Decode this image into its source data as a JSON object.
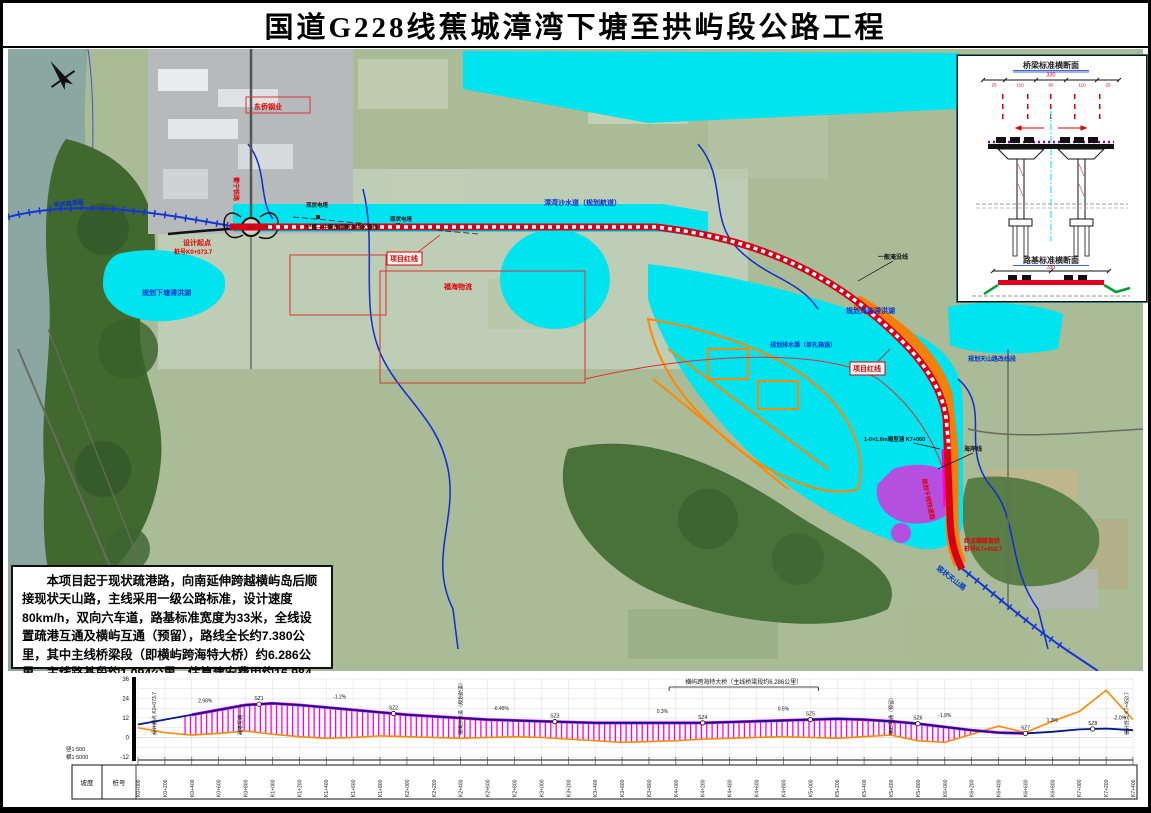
{
  "title": "国道G228线蕉城漳湾下塘至拱屿段公路工程",
  "description": "本项目起于现状疏港路，向南延伸跨越横屿岛后顺接现状天山路，主线采用一级公路标准，设计速度80km/h，双向六车道，路基标准宽度为33米，全线设置疏港互通及横屿互通（预留），路线全长约7.380公里，其中主线桥梁段（即横屿跨海特大桥）约6.286公里，主线路基段约1.094公里。估算建安费用约16.984亿元，总投资约20.931亿元。",
  "colors": {
    "route_red": "#d40018",
    "water_cyan": "#00e4f0",
    "boundary_blue": "#0b2fd0",
    "ground_orange": "#ff8800",
    "design_blue": "#001a8c",
    "bridge_hatch": "#ff00dd",
    "accent_purple": "#b44fe0",
    "label_red": "#e00000",
    "label_blue": "#0033cc"
  },
  "inset": {
    "section1_title": "桥梁标准横断面",
    "section2_title": "路基标准横断面",
    "total_width": "330",
    "dims": [
      "25",
      "110",
      "60",
      "110",
      "25"
    ]
  },
  "map_labels": [
    {
      "text": "项目红线",
      "x": 382,
      "y": 212,
      "color": "#e00000",
      "boxed": true,
      "leader": [
        432,
        186
      ]
    },
    {
      "text": "项目红线",
      "x": 845,
      "y": 322,
      "color": "#e00000",
      "boxed": true,
      "leader": [
        882,
        300
      ]
    },
    {
      "text": "设计起点",
      "x": 175,
      "y": 196,
      "color": "#e00000",
      "fs": 7
    },
    {
      "text": "桩号K0+073.7",
      "x": 166,
      "y": 205,
      "color": "#e00000",
      "fs": 6
    },
    {
      "text": "规划下塘滞洪湖",
      "x": 134,
      "y": 246,
      "color": "#0033cc",
      "fs": 7
    },
    {
      "text": "漳湾沙水道（规划航道）",
      "x": 536,
      "y": 156,
      "color": "#0033cc",
      "fs": 7
    },
    {
      "text": "规划海屿滞洪湖",
      "x": 838,
      "y": 264,
      "color": "#0033cc",
      "fs": 7
    },
    {
      "text": "规划排水渠（单孔箱涵）",
      "x": 762,
      "y": 298,
      "color": "#0033cc",
      "fs": 6
    },
    {
      "text": "一般淹没线",
      "x": 870,
      "y": 210,
      "color": "#111111",
      "fs": 6,
      "leader": [
        850,
        232
      ]
    },
    {
      "text": "海岸线",
      "x": 956,
      "y": 402,
      "color": "#111111",
      "fs": 6,
      "leader": [
        930,
        420
      ]
    },
    {
      "text": "现状天山路",
      "x": 928,
      "y": 520,
      "color": "#0033cc",
      "fs": 7,
      "rot": 38
    },
    {
      "text": "终点顺接现状",
      "x": 956,
      "y": 494,
      "color": "#e00000",
      "fs": 6
    },
    {
      "text": "桩号K7+453.7",
      "x": 956,
      "y": 502,
      "color": "#e00000",
      "fs": 6
    },
    {
      "text": "东侨钢业",
      "x": 246,
      "y": 60,
      "color": "#e00000",
      "fs": 7
    },
    {
      "text": "衢宁铁路",
      "x": 226,
      "y": 128,
      "color": "#e00000",
      "fs": 6,
      "rot": 90
    },
    {
      "text": "现状电塔",
      "x": 298,
      "y": 158,
      "color": "#111111",
      "fs": 5.5
    },
    {
      "text": "现状电塔",
      "x": 382,
      "y": 172,
      "color": "#111111",
      "fs": 5.5
    },
    {
      "text": "福海物流",
      "x": 436,
      "y": 240,
      "color": "#e00000",
      "fs": 7
    },
    {
      "text": "宁德—中铜东南铜业供水管线",
      "x": 298,
      "y": 180,
      "color": "#111111",
      "fs": 5.5
    },
    {
      "text": "规划天山路改线段",
      "x": 960,
      "y": 312,
      "color": "#0033cc",
      "fs": 6
    },
    {
      "text": "现状疏港路",
      "x": 46,
      "y": 158,
      "color": "#0033cc",
      "fs": 6,
      "rot": -6
    },
    {
      "text": "规划干线快速路",
      "x": 914,
      "y": 430,
      "color": "#e00000",
      "fs": 6,
      "rot": 78
    },
    {
      "text": "1-0×1.6m箱型涵 K7+060",
      "x": 856,
      "y": 392,
      "color": "#111111",
      "fs": 5.5,
      "leader": [
        932,
        400
      ]
    }
  ],
  "chart_data": {
    "type": "line",
    "title": "路线纵断面图",
    "xlabel": "桩号",
    "ylabel": "高程(m)",
    "ylim": [
      -12,
      36
    ],
    "yticks": [
      36,
      24,
      12,
      0,
      -12
    ],
    "scales": [
      "竖1:500",
      "横1:5000"
    ],
    "row_headers": [
      "坡度",
      "桩号"
    ],
    "x": [
      0,
      200,
      400,
      600,
      800,
      1000,
      1200,
      1400,
      1600,
      1800,
      2000,
      2200,
      2400,
      2600,
      2800,
      3000,
      3200,
      3400,
      3600,
      3800,
      4000,
      4200,
      4400,
      4600,
      4800,
      5000,
      5200,
      5400,
      5600,
      5800,
      6000,
      6200,
      6400,
      6600,
      6800,
      7000,
      7200,
      7400
    ],
    "series": [
      {
        "name": "设计线",
        "values": [
          8,
          11,
          14,
          17,
          20,
          21,
          20,
          18.5,
          17,
          15.5,
          14,
          13,
          12,
          11,
          10.5,
          10,
          9.5,
          9,
          9,
          9,
          9,
          9,
          9.5,
          10,
          10.5,
          11,
          11.5,
          11,
          10,
          8.5,
          6.5,
          4.5,
          3,
          2.5,
          3.5,
          5,
          5.5,
          4.5
        ]
      },
      {
        "name": "地面线",
        "values": [
          6,
          3,
          1.5,
          2.5,
          4,
          2,
          0.5,
          -0.5,
          0,
          1,
          0.5,
          0,
          -0.5,
          0,
          0.5,
          0,
          -1,
          -2,
          -3,
          -2.5,
          -2,
          -1,
          -0.5,
          0,
          0.5,
          0,
          -0.5,
          0.5,
          1.5,
          -2,
          -3,
          2,
          7,
          3,
          10,
          16,
          29,
          11
        ]
      }
    ],
    "colors": {
      "design": "#001a8c",
      "ground": "#ff8800",
      "hatch": "#ff00dd"
    },
    "bridge_range": [
      350,
      6650
    ],
    "bracket": {
      "from": 3950,
      "to": 5060,
      "label": "横屿跨海特大桥（主线桥梁段约6.286公里）"
    },
    "sz_points": [
      {
        "s": 900,
        "label": "SZ1"
      },
      {
        "s": 1900,
        "label": "SZ2"
      },
      {
        "s": 3100,
        "label": "SZ3"
      },
      {
        "s": 4200,
        "label": "SZ4"
      },
      {
        "s": 5000,
        "label": "SZ5"
      },
      {
        "s": 5800,
        "label": "SZ6"
      },
      {
        "s": 6600,
        "label": "SZ7"
      },
      {
        "s": 7100,
        "label": "SZ8"
      }
    ],
    "slope_labels": [
      {
        "s": 500,
        "text": "2.98%"
      },
      {
        "s": 1500,
        "text": "-1.2%"
      },
      {
        "s": 2700,
        "text": "-0.45%"
      },
      {
        "s": 3900,
        "text": "0.3%"
      },
      {
        "s": 4800,
        "text": "0.5%"
      },
      {
        "s": 6000,
        "text": "-1.9%"
      },
      {
        "s": 6800,
        "text": "1.3%"
      },
      {
        "s": 7300,
        "text": "-2.0%"
      }
    ],
    "annotations": [
      {
        "s": 120,
        "text": "设计起点 K0+073.7"
      },
      {
        "s": 760,
        "text": "疏港互通"
      },
      {
        "s": 2400,
        "text": "漳湾沙水道（规划航道）"
      },
      {
        "s": 5600,
        "text": "横屿互通（预留）"
      },
      {
        "s": 7350,
        "text": "设计终点 K7+453.7"
      }
    ]
  }
}
